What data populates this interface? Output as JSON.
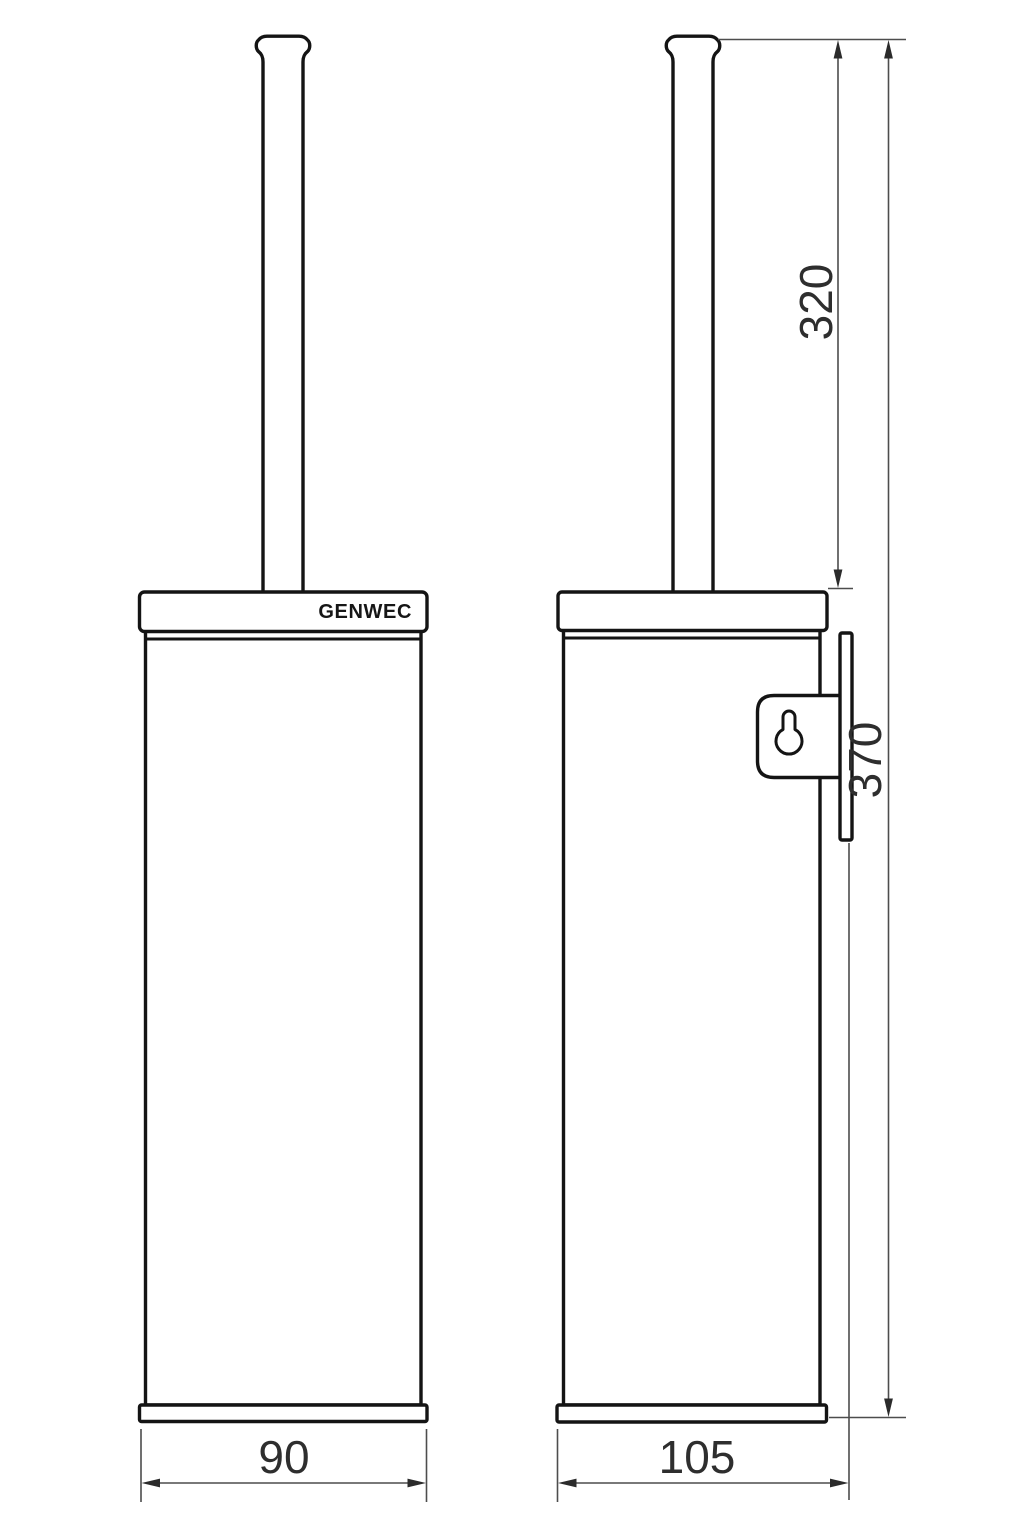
{
  "drawing": {
    "brand_label": "GENWEC",
    "product": "wall-mounted toilet brush holder technical drawing",
    "colors": {
      "object_line": "#141414",
      "dimension_line": "#4d4d4d",
      "background": "#ffffff"
    },
    "dimensions": {
      "front_width": "90",
      "side_depth": "105",
      "handle_height": "320",
      "total_height": "370"
    }
  }
}
